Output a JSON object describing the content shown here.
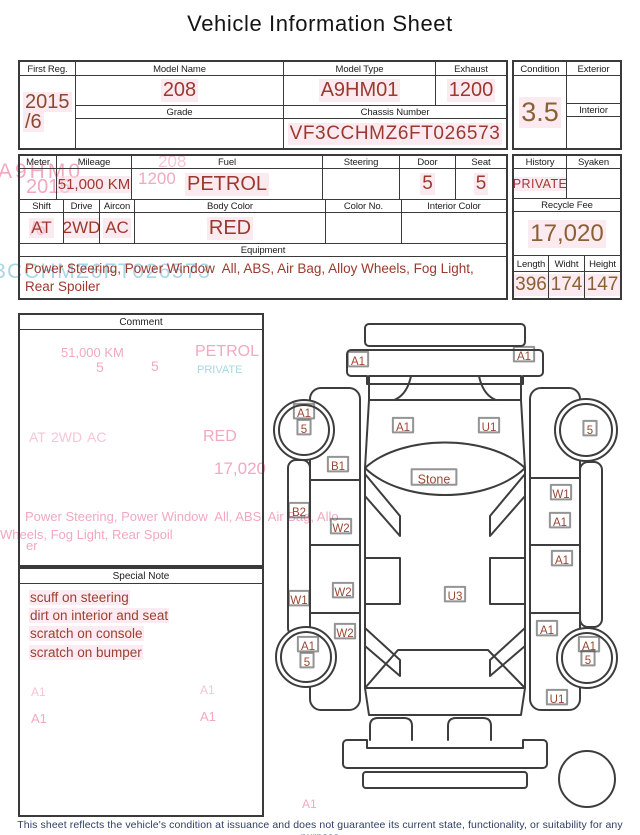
{
  "title": "Vehicle Information Sheet",
  "colors": {
    "value_red": "#9c392e",
    "value_brown": "#8a6134",
    "first_reg_brown": "#8a4a2f",
    "border_gray": "#3a3a3a",
    "ghost_pink": "#f2a9bd",
    "ghost_pink_light": "#f7c6d2",
    "ghost_cyan": "#a9d6e4",
    "note_red": "#9c4130",
    "diagram_label_red": "#9b4733",
    "disclaimer_navy": "#2e3f63",
    "highlight_pink": "#fbe4ee"
  },
  "table1": {
    "first_reg": {
      "label": "First Reg.",
      "line1": "2015",
      "line2": "/6"
    },
    "model_name": {
      "label": "Model Name",
      "value": "208"
    },
    "model_type": {
      "label": "Model Type",
      "value": "A9HM01"
    },
    "exhaust": {
      "label": "Exhaust",
      "value": "1200"
    },
    "grade": {
      "label": "Grade",
      "value": ""
    },
    "chassis": {
      "label": "Chassis Number",
      "value": "VF3CCHMZ6FT026573"
    },
    "condition": {
      "label": "Condition",
      "value": "3.5"
    },
    "exterior": {
      "label": "Exterior",
      "value": ""
    },
    "interior": {
      "label": "Interior",
      "value": ""
    }
  },
  "table2": {
    "meter": {
      "label": "Meter",
      "value": ""
    },
    "mileage": {
      "label": "Mileage",
      "value": "51,000 KM"
    },
    "fuel": {
      "label": "Fuel",
      "value": "PETROL"
    },
    "steering": {
      "label": "Steering",
      "value": ""
    },
    "door": {
      "label": "Door",
      "value": "5"
    },
    "seat": {
      "label": "Seat",
      "value": "5"
    },
    "shift": {
      "label": "Shift",
      "value": "AT"
    },
    "drive": {
      "label": "Drive",
      "value": "2WD"
    },
    "aircon": {
      "label": "Aircon",
      "value": "AC"
    },
    "body_color": {
      "label": "Body Color",
      "value": "RED"
    },
    "color_no": {
      "label": "Color No.",
      "value": ""
    },
    "interior_color": {
      "label": "Interior Color",
      "value": ""
    },
    "equipment": {
      "label": "Equipment",
      "value": "Power Steering, Power Window  All, ABS, Air Bag, Alloy Wheels, Fog Light, Rear Spoiler"
    },
    "history": {
      "label": "History",
      "value": "PRIVATE"
    },
    "syaken": {
      "label": "Syaken",
      "value": ""
    },
    "recycle_fee": {
      "label": "Recycle Fee",
      "value": "17,020"
    },
    "length": {
      "label": "Length",
      "value": "396"
    },
    "width": {
      "label": "Widht",
      "value": "174"
    },
    "height": {
      "label": "Height",
      "value": "147"
    }
  },
  "comment": {
    "label": "Comment"
  },
  "special_note": {
    "label": "Special Note",
    "lines": [
      "scuff on steering",
      "dirt on interior and seat",
      "scratch on console",
      "scratch on bumper"
    ]
  },
  "diagram": {
    "labels": [
      {
        "t": "A1",
        "x": 88,
        "y": 51
      },
      {
        "t": "A1",
        "x": 254,
        "y": 46
      },
      {
        "t": "A1",
        "x": 34,
        "y": 103
      },
      {
        "t": "5",
        "x": 34,
        "y": 119
      },
      {
        "t": "A1",
        "x": 133,
        "y": 117
      },
      {
        "t": "U1",
        "x": 219,
        "y": 117
      },
      {
        "t": "5",
        "x": 320,
        "y": 120
      },
      {
        "t": "B1",
        "x": 68,
        "y": 156
      },
      {
        "t": "Stone",
        "x": 164,
        "y": 169,
        "s": 12.5
      },
      {
        "t": "W1",
        "x": 291,
        "y": 184
      },
      {
        "t": "B2",
        "x": 29,
        "y": 202
      },
      {
        "t": "W2",
        "x": 71,
        "y": 218
      },
      {
        "t": "A1",
        "x": 290,
        "y": 212
      },
      {
        "t": "A1",
        "x": 292,
        "y": 250
      },
      {
        "t": "W1",
        "x": 29,
        "y": 290
      },
      {
        "t": "W2",
        "x": 73,
        "y": 282
      },
      {
        "t": "U3",
        "x": 185,
        "y": 286
      },
      {
        "t": "W2",
        "x": 75,
        "y": 323
      },
      {
        "t": "A1",
        "x": 277,
        "y": 320
      },
      {
        "t": "A1",
        "x": 38,
        "y": 336
      },
      {
        "t": "5",
        "x": 37,
        "y": 352
      },
      {
        "t": "A1",
        "x": 319,
        "y": 336
      },
      {
        "t": "5",
        "x": 318,
        "y": 350
      },
      {
        "t": "U1",
        "x": 287,
        "y": 389
      }
    ]
  },
  "ghosts": [
    {
      "t": "A9HM0",
      "x": -2,
      "y": 160,
      "s": 21,
      "c": "#f2a9bd",
      "sp": 3
    },
    {
      "t": "2015",
      "x": 26,
      "y": 176,
      "s": 20,
      "c": "#f2a9bd"
    },
    {
      "t": "/6",
      "x": 30,
      "y": 220,
      "s": 19,
      "c": "#f2a9bd"
    },
    {
      "t": "208",
      "x": 158,
      "y": 153,
      "s": 17,
      "c": "#f7c6d2"
    },
    {
      "t": "1200",
      "x": 138,
      "y": 170,
      "s": 17,
      "c": "#f2a9bd"
    },
    {
      "t": "3CCHMZ6FT026573",
      "x": -6,
      "y": 260,
      "s": 21,
      "c": "#a9d6e4",
      "sp": 1.5
    },
    {
      "t": "51,000 KM",
      "x": 61,
      "y": 346,
      "s": 13,
      "c": "#f2a9bd"
    },
    {
      "t": "5",
      "x": 96,
      "y": 360,
      "s": 14,
      "c": "#f2a9bd"
    },
    {
      "t": "5",
      "x": 151,
      "y": 359,
      "s": 14,
      "c": "#f2a9bd"
    },
    {
      "t": "PETROL",
      "x": 195,
      "y": 343,
      "s": 16,
      "c": "#f2a9bd"
    },
    {
      "t": "PRIVATE",
      "x": 197,
      "y": 364,
      "s": 11,
      "c": "#a9d6e4"
    },
    {
      "t": "AT",
      "x": 29,
      "y": 430,
      "s": 14,
      "c": "#f7c6d2"
    },
    {
      "t": "2WD",
      "x": 51,
      "y": 430,
      "s": 14,
      "c": "#f7c6d2"
    },
    {
      "t": "AC",
      "x": 87,
      "y": 430,
      "s": 14,
      "c": "#f7c6d2"
    },
    {
      "t": "RED",
      "x": 203,
      "y": 428,
      "s": 16,
      "c": "#f2a9bd"
    },
    {
      "t": "17,020",
      "x": 214,
      "y": 460,
      "s": 17,
      "c": "#f2a9bd"
    },
    {
      "t": "Power Steering, Power Window  All, ABS, Air Bag, Allo",
      "x": 25,
      "y": 510,
      "s": 13,
      "c": "#f2a9bd"
    },
    {
      "t": "Wheels, Fog Light, Rear Spoil",
      "x": 0,
      "y": 528,
      "s": 13,
      "c": "#f2a9bd"
    },
    {
      "t": "er",
      "x": 26,
      "y": 539,
      "s": 13,
      "c": "#f2a9bd"
    },
    {
      "t": "A1",
      "x": 31,
      "y": 686,
      "s": 12,
      "c": "#f7c6d2"
    },
    {
      "t": "A1",
      "x": 200,
      "y": 684,
      "s": 12,
      "c": "#f7c6d2"
    },
    {
      "t": "A1",
      "x": 31,
      "y": 712,
      "s": 13,
      "c": "#f2a9bd"
    },
    {
      "t": "A1",
      "x": 200,
      "y": 710,
      "s": 13,
      "c": "#f2a9bd"
    },
    {
      "t": "A1",
      "x": 302,
      "y": 798,
      "s": 12,
      "c": "#f2a9bd"
    }
  ],
  "footer": {
    "disclaimer": "This sheet reflects the vehicle's condition at issuance and does not guarantee its current state, functionality, or suitability for any purpose"
  }
}
